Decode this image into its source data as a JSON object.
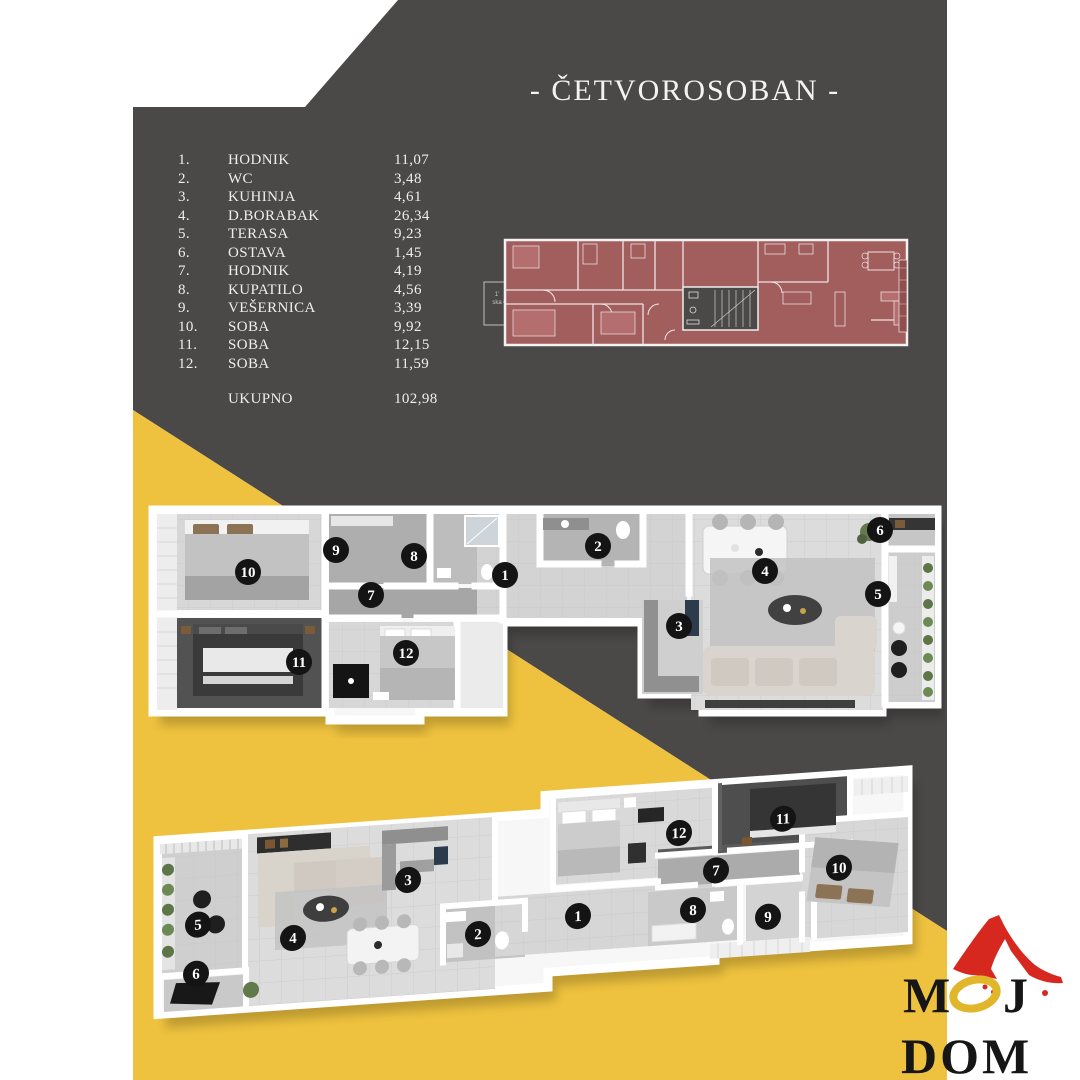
{
  "title": "- ČETVOROSOBAN -",
  "table": {
    "rows": [
      {
        "no": "1.",
        "name": "HODNIK",
        "area": "11,07"
      },
      {
        "no": "2.",
        "name": "WC",
        "area": "3,48"
      },
      {
        "no": "3.",
        "name": "KUHINJA",
        "area": "4,61"
      },
      {
        "no": "4.",
        "name": "D.BORABAK",
        "area": "26,34"
      },
      {
        "no": "5.",
        "name": "TERASA",
        "area": "9,23"
      },
      {
        "no": "6.",
        "name": "OSTAVA",
        "area": "1,45"
      },
      {
        "no": "7.",
        "name": "HODNIK",
        "area": "4,19"
      },
      {
        "no": "8.",
        "name": "KUPATILO",
        "area": "4,56"
      },
      {
        "no": "9.",
        "name": "VEŠERNICA",
        "area": "3,39"
      },
      {
        "no": "10.",
        "name": "SOBA",
        "area": "9,92"
      },
      {
        "no": "11.",
        "name": "SOBA",
        "area": "12,15"
      },
      {
        "no": "12.",
        "name": "SOBA",
        "area": "11,59"
      }
    ],
    "total_label": "UKUPNO",
    "total_value": "102,98"
  },
  "badges": [
    "1",
    "2",
    "3",
    "4",
    "5",
    "6",
    "7",
    "8",
    "9",
    "10",
    "11",
    "12"
  ],
  "plan2d": {
    "note_line1": "1'",
    "note_line2": "ska"
  },
  "logo": {
    "m": "M",
    "j": "J",
    "dom": "DOM"
  },
  "colors": {
    "panel_gray": "#4b4848",
    "accent_yellow": "#eec23e",
    "plan_red": "#a25d5d",
    "badge_black": "#141414",
    "logo_red": "#d7281f",
    "logo_yellow": "#e2b62b"
  }
}
